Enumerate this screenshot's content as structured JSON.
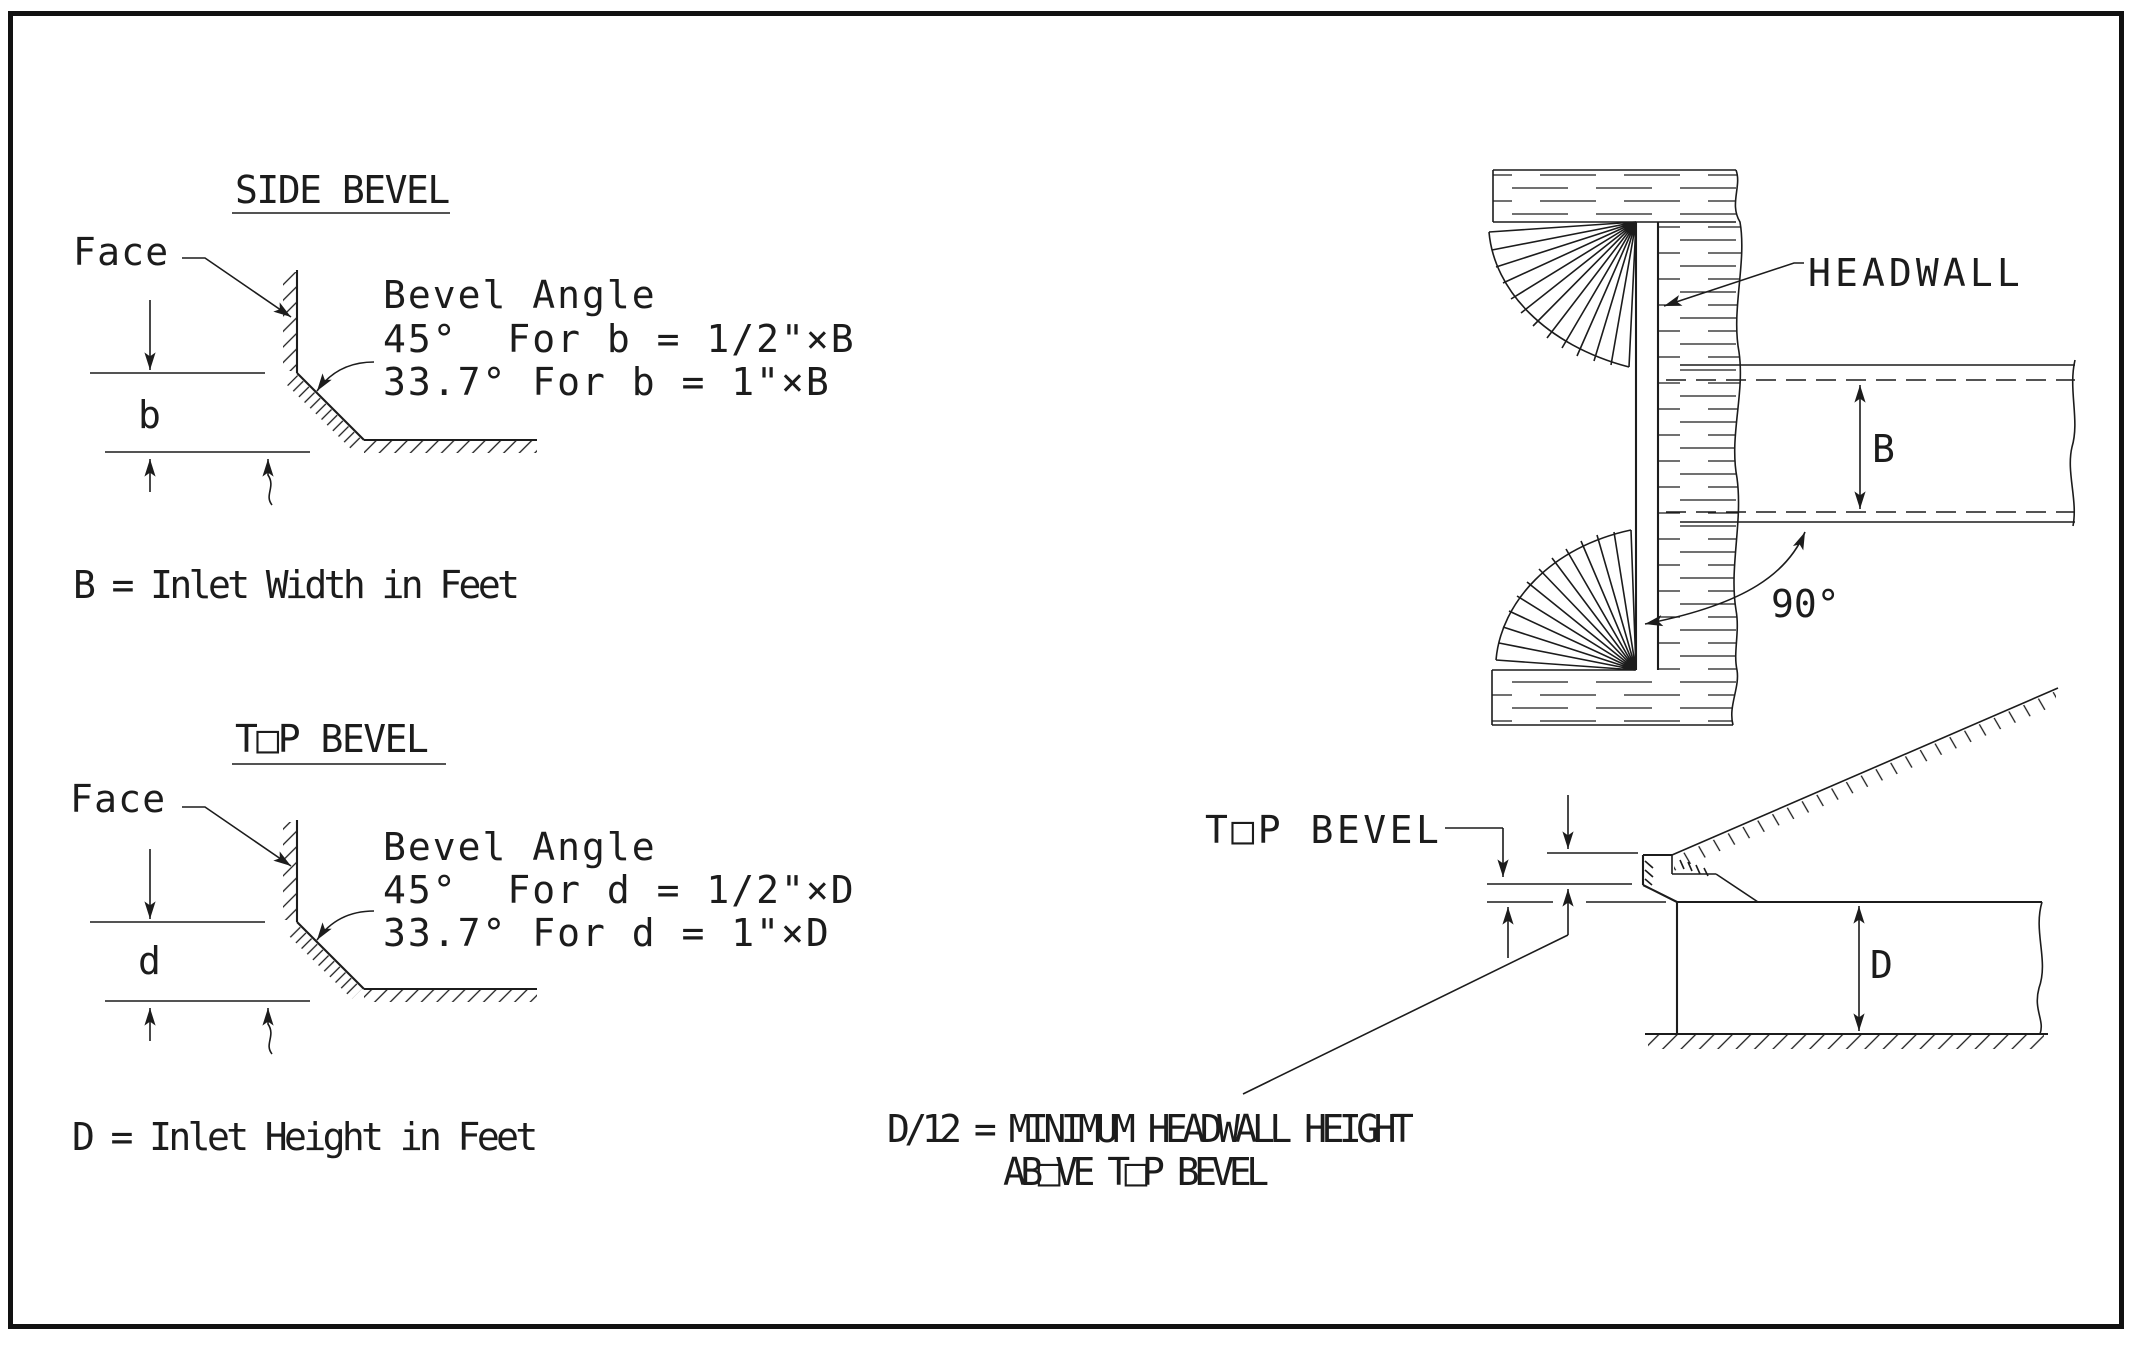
{
  "colors": {
    "line": "#1c1c1c",
    "background": "#ffffff"
  },
  "side_bevel": {
    "title": "SIDE BEVEL",
    "face_label": "Face",
    "angle_title": "Bevel Angle",
    "angle_45": "45°  For b = 1/2\"×B",
    "angle_337": "33.7° For b = 1\"×B",
    "dim_label": "b",
    "caption": "B = Inlet Width in Feet"
  },
  "top_bevel": {
    "title": "T□P BEVEL",
    "face_label": "Face",
    "angle_title": "Bevel Angle",
    "angle_45": "45°  For d = 1/2\"×D",
    "angle_337": "33.7° For d = 1\"×D",
    "dim_label": "d",
    "caption": "D = Inlet Height in Feet"
  },
  "headwall_plan": {
    "headwall_label": "HEADWALL",
    "width_dim_label": "B",
    "skew_angle_label": "90°"
  },
  "headwall_elevation": {
    "top_bevel_label": "T□P BEVEL",
    "height_dim_label": "D",
    "note_line1": "D/12 = MINIMUM HEADWALL HEIGHT",
    "note_line2": "AB□VE T□P BEVEL"
  }
}
